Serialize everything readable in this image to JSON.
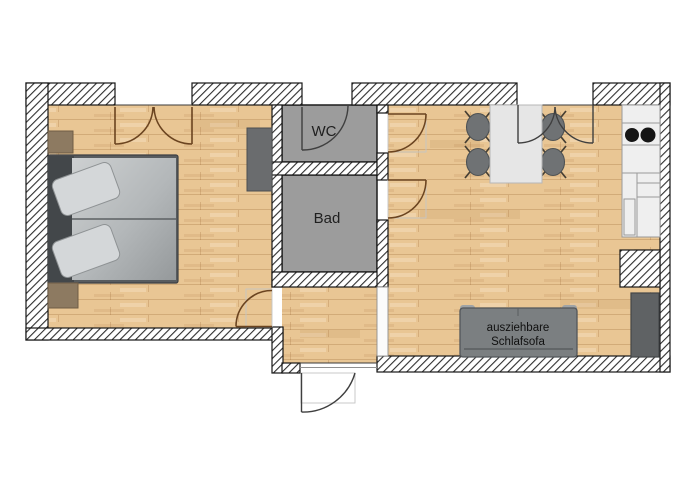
{
  "plan": {
    "room_labels": {
      "wc": "WC",
      "bathroom": "Bad"
    },
    "sofa_label": {
      "line1": "ausziehbare",
      "line2": "Schlafsofa"
    }
  },
  "colors": {
    "background": "#ffffff",
    "wood_floor": "#e9c694",
    "wood_plank_line": "rgba(150,100,48,0.28)",
    "tile_floor": "#9c9c9c",
    "wall_hatch_line": "#2e2e2e",
    "outline": "#161616",
    "door_arc_brown": "#6b4420",
    "door_arc_dark": "#3f3f3f",
    "bed_frame": "#585c5f",
    "bed_head_band": "#43474a",
    "pillow": "#d4d7d9",
    "wood_furniture": "#8d7a61",
    "furniture_dark": "#5f6264",
    "cabinet_gray": "#6a6c6e",
    "sofa_gray": "#7b7f81",
    "sofa_tab": "#9fa3a5",
    "table_white": "#e6e6e6",
    "chair_gray": "#6f7274",
    "counter_white": "#efefef",
    "cooktop_black": "#151515"
  }
}
